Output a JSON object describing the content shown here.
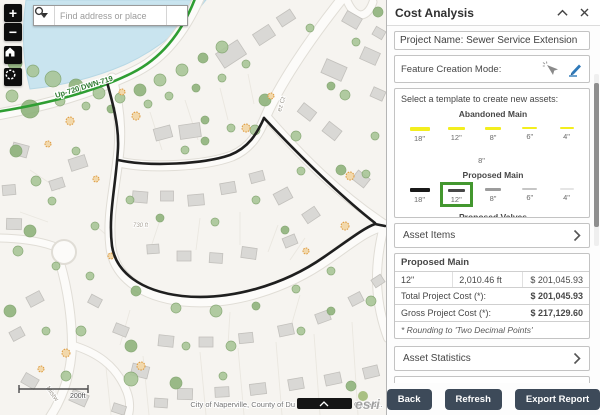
{
  "map": {
    "search_placeholder": "Find address or place",
    "controls": {
      "zoom_in": "+",
      "zoom_out": "−"
    },
    "labels": {
      "utility_line": "Up-720 DWN-719",
      "street_ct": "ez Ct",
      "street_sw": "Mistw",
      "parcel_area": "730 ft"
    },
    "scalebar_label": "200ft",
    "attribution_left": "City of Naperville, County of Du",
    "attribution_right": "Canad...",
    "esri_logo": "esri"
  },
  "panel": {
    "title": "Cost Analysis",
    "project_name": "Project Name: Sewer Service Extension",
    "feature_mode_label": "Feature Creation Mode:",
    "template_prompt": "Select a template to create new assets:",
    "template_groups": [
      {
        "name": "Abandoned Main",
        "items": [
          {
            "label": "18\"",
            "color": "#f3ee1e",
            "thickness": 4,
            "length": 20
          },
          {
            "label": "12\"",
            "color": "#f3ee1e",
            "thickness": 3,
            "length": 17
          },
          {
            "label": "8\"",
            "color": "#f3ee1e",
            "thickness": 3,
            "length": 16
          },
          {
            "label": "6\"",
            "color": "#f3ee1e",
            "thickness": 2,
            "length": 15
          },
          {
            "label": "4\"",
            "color": "#f3ee1e",
            "thickness": 2,
            "length": 14
          },
          {
            "label": "8\"",
            "color": "transparent",
            "thickness": 3,
            "length": 16,
            "wrap": true
          }
        ]
      },
      {
        "name": "Proposed Main",
        "items": [
          {
            "label": "18\"",
            "color": "#191919",
            "thickness": 4,
            "length": 20
          },
          {
            "label": "12\"",
            "color": "#474747",
            "thickness": 3,
            "length": 17,
            "selected": true
          },
          {
            "label": "8\"",
            "color": "#9c9c9c",
            "thickness": 3,
            "length": 16
          },
          {
            "label": "6\"",
            "color": "#c6c6c6",
            "thickness": 2,
            "length": 15
          },
          {
            "label": "4\"",
            "color": "#e5e5e5",
            "thickness": 2,
            "length": 14
          }
        ]
      },
      {
        "name": "Proposed Valves",
        "items": []
      }
    ],
    "asset_items_label": "Asset Items",
    "cost_table": {
      "header": "Proposed Main",
      "rows": [
        [
          "12\"",
          "2,010.46 ft",
          "$ 201,045.93"
        ]
      ],
      "totals": [
        {
          "label": "Total Project Cost (*):",
          "value": "$ 201,045.93"
        },
        {
          "label": "Gross Project Cost (*):",
          "value": "$ 217,129.60"
        }
      ],
      "footnote": "* Rounding to 'Two Decimal Points'"
    },
    "asset_statistics_label": "Asset Statistics",
    "project_summary_label": "Project Summary",
    "buttons": {
      "back": "Back",
      "refresh": "Refresh",
      "export": "Export Report"
    }
  },
  "colors": {
    "selection_green": "#43972f",
    "abandoned_yellow": "#f3ee1e",
    "proposed_black": "#1f1f1f",
    "existing_main_green": "#2f9e33",
    "water_blue": "#c9e4ef",
    "button_navy": "#3d4a59",
    "pencil_blue": "#2e79b9"
  }
}
